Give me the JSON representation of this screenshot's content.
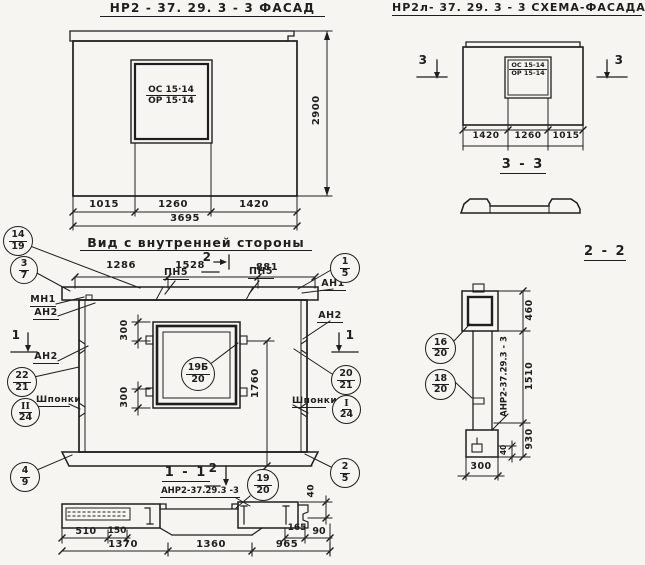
{
  "colors": {
    "paper": "#f6f5f1",
    "ink": "#1e1e1e"
  },
  "facade": {
    "title": "НР2 - 37. 29. 3  - 3    ФАСАД",
    "window_mark_top": "ОС 15·14",
    "window_mark_bottom": "ОР 15·14",
    "dim_height": "2900",
    "dims_bottom": [
      "1015",
      "1260",
      "1420"
    ],
    "dim_total": "3695"
  },
  "schema": {
    "title": "НР2л- 37. 29. 3  - 3  СХЕМА-ФАСАДА",
    "window_mark_top": "ОС 15-14",
    "window_mark_bottom": "ОР 15-14",
    "marker_left": "3",
    "marker_right": "3",
    "dims_bottom": [
      "1420",
      "1260",
      "1015"
    ]
  },
  "section33": {
    "title": "3 - 3"
  },
  "inner": {
    "title": "Вид с внутренней  стороны",
    "dims_top": [
      "1286",
      "1528",
      "881"
    ],
    "marker_top": "2",
    "pn1": "ПН5",
    "pn2": "ПН5",
    "mn1": "МН1",
    "an2_left_top": "АН2",
    "an2_left": "АН2",
    "an1_right": "АН1",
    "an2_right": "АН2",
    "shponki_left": "Шпонки",
    "shponki_right": "Шпонки",
    "marker1_left": "1",
    "marker1_right": "1",
    "dim_300_top": "300",
    "dim_300_bottom": "300",
    "dim_1760": "1760"
  },
  "section11": {
    "title": "1 - 1",
    "marker": "2",
    "subtitle": "АНР2-37.29.3 -3",
    "dim_40": "40",
    "dim_510": "510",
    "dim_150": "150",
    "dim_165": "165",
    "dim_90": "90",
    "dims_main": [
      "1370",
      "1360",
      "965"
    ]
  },
  "section22": {
    "title": "2 - 2",
    "label_vertical": "АНР2-37.29.3 - 3",
    "dim_460": "460",
    "dim_1510": "1510",
    "dim_930": "930",
    "dim_40": "40",
    "dim_300": "300"
  },
  "callouts": [
    {
      "top": "14",
      "bottom": "19"
    },
    {
      "top": "3",
      "bottom": "7"
    },
    {
      "top": "22",
      "bottom": "21"
    },
    {
      "top": "II",
      "bottom": "24"
    },
    {
      "top": "4",
      "bottom": "9"
    },
    {
      "top": "1",
      "bottom": "5"
    },
    {
      "top": "20",
      "bottom": "21"
    },
    {
      "top": "I",
      "bottom": "24"
    },
    {
      "top": "2",
      "bottom": "5"
    },
    {
      "top": "19Б",
      "bottom": "20"
    },
    {
      "top": "19",
      "bottom": "20"
    },
    {
      "top": "16",
      "bottom": "20"
    },
    {
      "top": "18",
      "bottom": "20"
    }
  ]
}
